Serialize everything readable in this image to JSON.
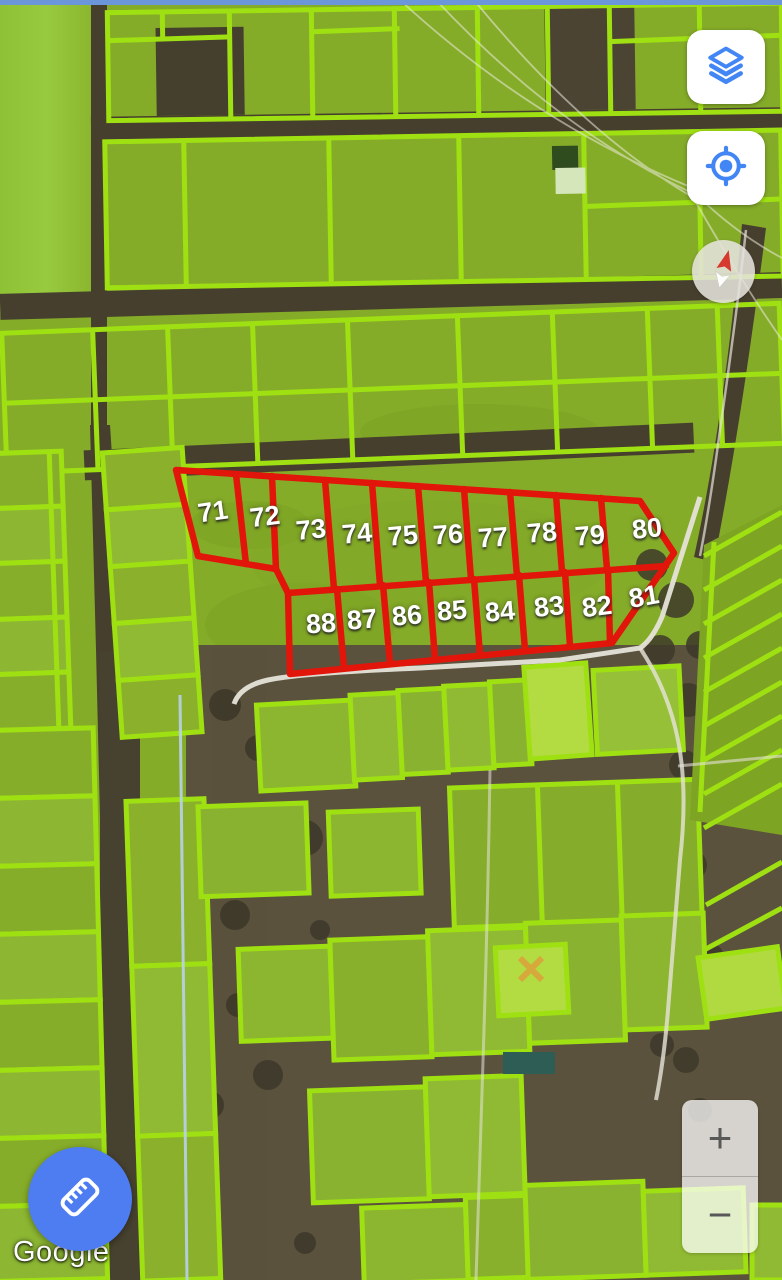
{
  "map": {
    "watermark": "Google",
    "red_parcels": {
      "numbers": [
        {
          "text": "71",
          "x": 213,
          "y": 512,
          "rot": -8
        },
        {
          "text": "72",
          "x": 265,
          "y": 517,
          "rot": -7
        },
        {
          "text": "73",
          "x": 311,
          "y": 530,
          "rot": -6
        },
        {
          "text": "74",
          "x": 357,
          "y": 534,
          "rot": -5
        },
        {
          "text": "75",
          "x": 403,
          "y": 536,
          "rot": -5
        },
        {
          "text": "76",
          "x": 448,
          "y": 535,
          "rot": -4
        },
        {
          "text": "77",
          "x": 493,
          "y": 538,
          "rot": -4
        },
        {
          "text": "78",
          "x": 542,
          "y": 533,
          "rot": -5
        },
        {
          "text": "79",
          "x": 590,
          "y": 536,
          "rot": -5
        },
        {
          "text": "80",
          "x": 647,
          "y": 529,
          "rot": -6
        },
        {
          "text": "81",
          "x": 644,
          "y": 597,
          "rot": -10
        },
        {
          "text": "82",
          "x": 597,
          "y": 607,
          "rot": -7
        },
        {
          "text": "83",
          "x": 549,
          "y": 607,
          "rot": -6
        },
        {
          "text": "84",
          "x": 500,
          "y": 612,
          "rot": -5
        },
        {
          "text": "85",
          "x": 452,
          "y": 611,
          "rot": -5
        },
        {
          "text": "86",
          "x": 407,
          "y": 616,
          "rot": -5
        },
        {
          "text": "87",
          "x": 362,
          "y": 620,
          "rot": -5
        },
        {
          "text": "88",
          "x": 321,
          "y": 624,
          "rot": -4
        }
      ]
    },
    "colors": {
      "parcel_outline_green": "#9fe012",
      "selection_red": "#e2150a",
      "label_text": "#ffffff",
      "field_green_base": "#85ac29",
      "road_dark_brown": "#473f2e",
      "white_road": "#e6e3d8",
      "power_line_blue": "#b9d2ec",
      "fab_blue": "#4e7df2",
      "control_icon_blue": "#4285f4",
      "zoom_glyph_gray": "#585858"
    }
  },
  "controls": {
    "layers_button": {
      "icon": "layers-icon"
    },
    "locate_button": {
      "icon": "locate-icon"
    },
    "compass": {
      "icon": "compass-needle-icon"
    },
    "zoom": {
      "in_label": "+",
      "out_label": "−"
    },
    "measure_button": {
      "icon": "ruler-icon"
    }
  }
}
